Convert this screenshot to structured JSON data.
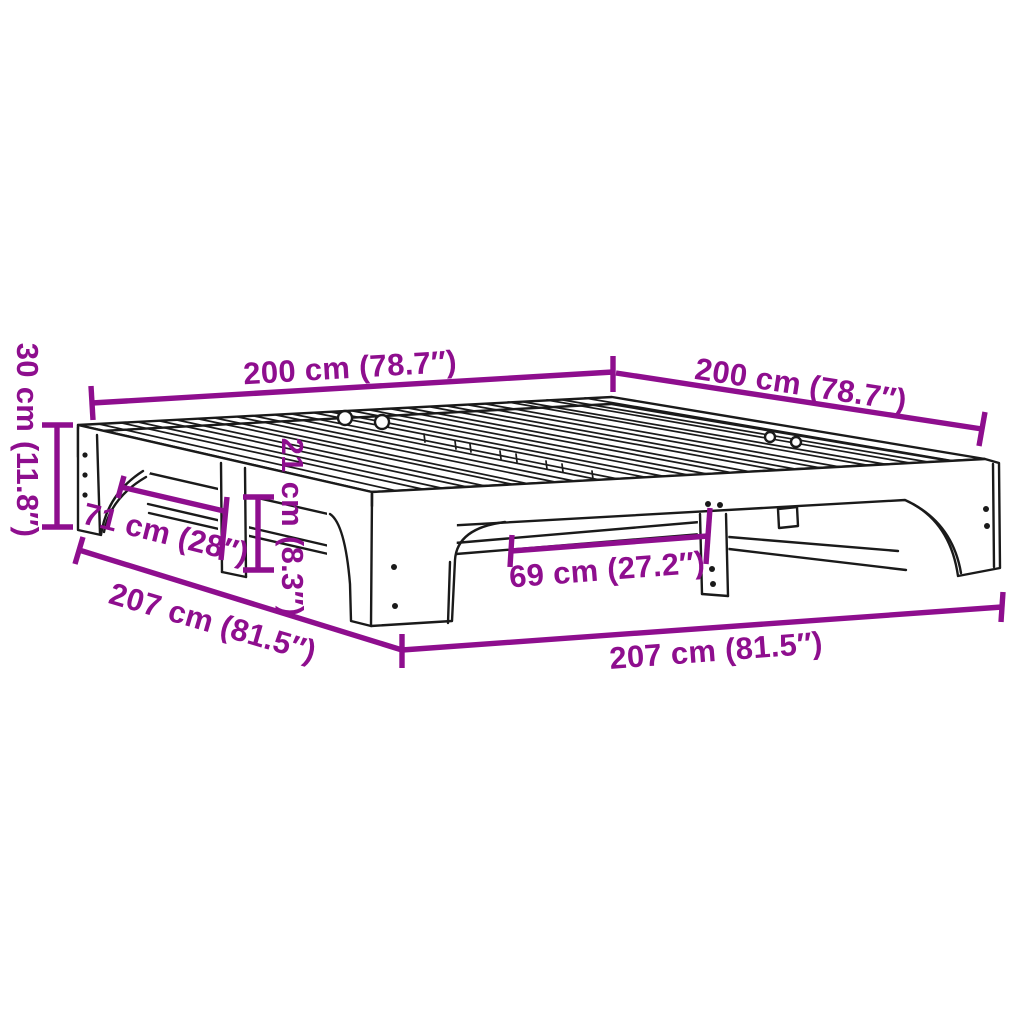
{
  "diagram": {
    "subject": "Slatted bed frame — isometric product dimension drawing",
    "colors": {
      "dimension": "#8E0E8E",
      "outline": "#1a1a1a",
      "background": "#ffffff"
    },
    "labels": {
      "width_top_left": "200 cm (78.7″)",
      "depth_top_right": "200 cm (78.7″)",
      "height_left": "30 cm (11.8″)",
      "arch_span_left": "71 cm (28″)",
      "clearance_center": "21 cm (8.3″)",
      "arch_span_front": "69 cm (27.2″)",
      "outer_length_lower_left": "207 cm (81.5″)",
      "outer_length_bottom": "207 cm (81.5″)"
    }
  }
}
